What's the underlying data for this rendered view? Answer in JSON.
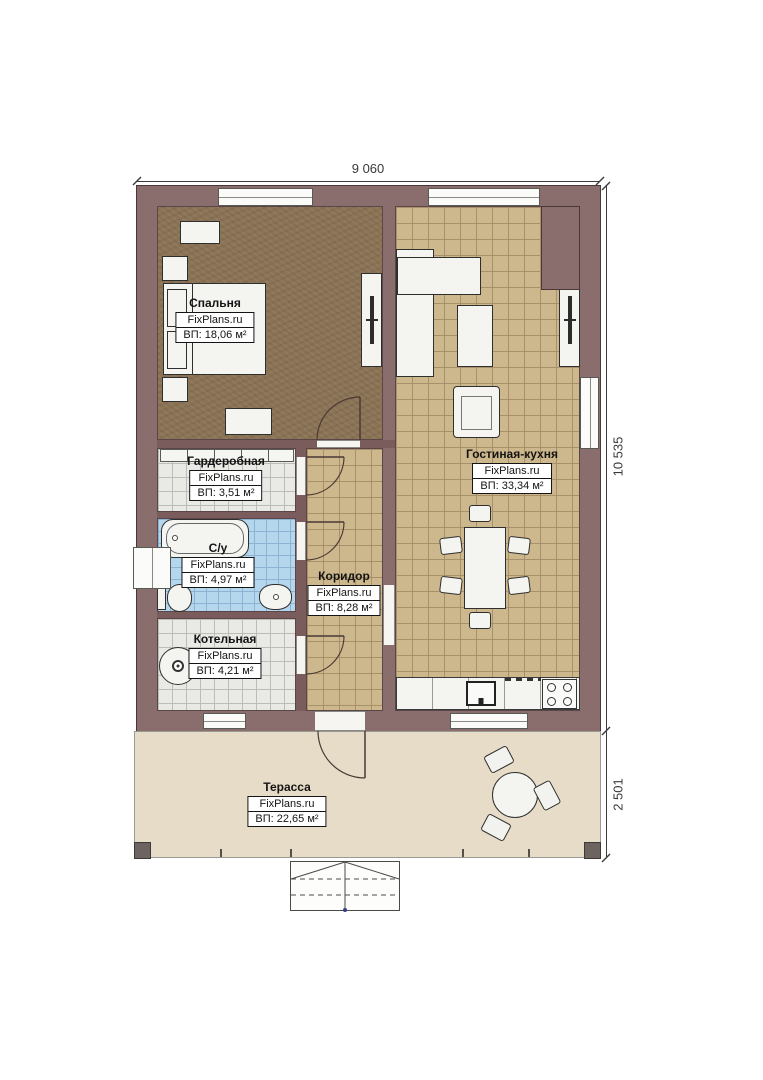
{
  "brand": "FixPlans.ru",
  "dimensions": {
    "width_top": "9 060",
    "height_right": "10 535",
    "terrace_depth": "2 501"
  },
  "rooms": {
    "bedroom": {
      "name": "Спальня",
      "brand": "FixPlans.ru",
      "area": "ВП: 18,06 м²"
    },
    "wardrobe": {
      "name": "Гардеробная",
      "brand": "FixPlans.ru",
      "area": "ВП: 3,51 м²"
    },
    "bathroom": {
      "name": "С/у",
      "brand": "FixPlans.ru",
      "area": "ВП: 4,97 м²"
    },
    "boiler": {
      "name": "Котельная",
      "brand": "FixPlans.ru",
      "area": "ВП: 4,21 м²"
    },
    "corridor": {
      "name": "Коридор",
      "brand": "FixPlans.ru",
      "area": "ВП: 8,28 м²"
    },
    "living_kitchen": {
      "name": "Гостиная-кухня",
      "brand": "FixPlans.ru",
      "area": "ВП: 33,34 м²"
    },
    "terrace": {
      "name": "Терасса",
      "brand": "FixPlans.ru",
      "area": "ВП: 22,65 м²"
    }
  },
  "colors": {
    "wall": "#8a6d6d",
    "wall_inner": "#7a5c5c",
    "bedroom_floor": "#8a7254",
    "tile_tan": "#cdb78c",
    "tile_blue": "#b4d7ee",
    "tile_grey": "#e9e9e6",
    "terrace_floor": "#e7dcc7"
  }
}
